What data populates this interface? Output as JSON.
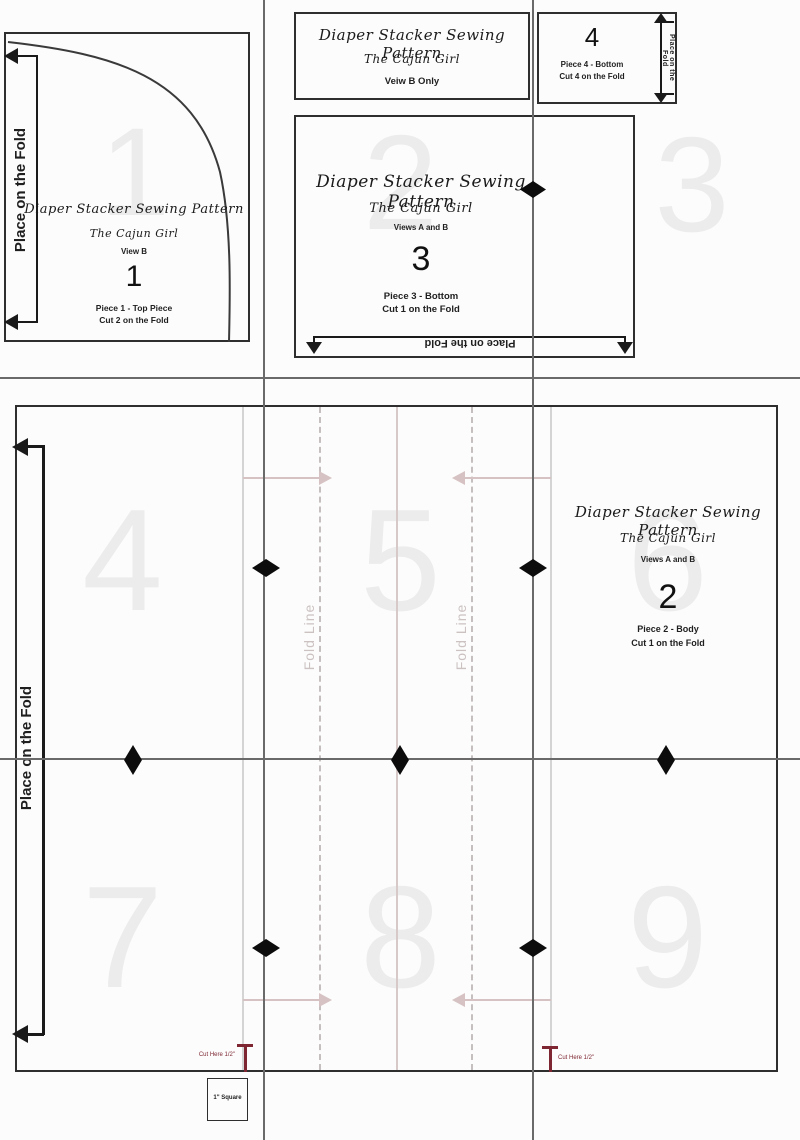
{
  "doc": {
    "title": "Diaper Stacker Sewing Pattern",
    "brand": "The Cajun Girl"
  },
  "labels": {
    "place_on_fold": "Place on the Fold",
    "fold_line": "Fold Line",
    "cut_here": "Cut Here 1/2\"",
    "square": "1\" Square"
  },
  "pieces": {
    "title_block": {
      "view": "Veiw B Only"
    },
    "p1": {
      "view": "View B",
      "num": "1",
      "name": "Piece 1 - Top Piece",
      "cut": "Cut 2 on the Fold"
    },
    "p2": {
      "view": "Views A and B",
      "num": "2",
      "name": "Piece 2 - Body",
      "cut": "Cut 1 on the Fold"
    },
    "p3": {
      "view": "Views A and B",
      "num": "3",
      "name": "Piece 3 - Bottom",
      "cut": "Cut 1 on the Fold"
    },
    "p4": {
      "num": "4",
      "name": "Piece 4 - Bottom",
      "cut": "Cut 4 on the Fold"
    }
  },
  "ghosts": {
    "g1": "1",
    "g2": "2",
    "g3": "3",
    "g4": "4",
    "g5": "5",
    "g6": "6",
    "g7": "7",
    "g8": "8",
    "g9": "9"
  },
  "colors": {
    "ink": "#2e2e2e",
    "grid": "#6a6a6a",
    "ghost": "#ececec",
    "pink": "#d6c2c2",
    "red": "#7e2732"
  }
}
